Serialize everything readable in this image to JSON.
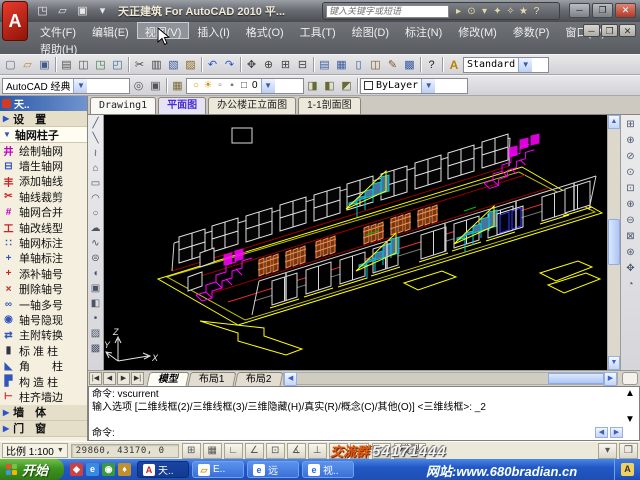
{
  "window": {
    "logo": "A",
    "app_title": "天正建筑 For AutoCAD 2010  平...",
    "controls": {
      "minimize": "─",
      "maximize": "❐",
      "close": "✕"
    },
    "mdi_controls": {
      "minimize": "─",
      "restore": "❐",
      "close": "✕"
    }
  },
  "infocenter": {
    "placeholder": "键入关键字或短语",
    "icons": [
      {
        "n": "infocenter-expand-icon",
        "g": "▸"
      },
      {
        "n": "search-binoculars-icon",
        "g": "⊙"
      },
      {
        "n": "search-dropdown-icon",
        "g": "▾"
      },
      {
        "n": "communication-center-icon",
        "g": "✦"
      },
      {
        "n": "subscription-center-icon",
        "g": "✧"
      },
      {
        "n": "favorites-star-icon",
        "g": "★"
      },
      {
        "n": "help-icon",
        "g": "?"
      }
    ]
  },
  "menu": {
    "items": [
      "文件(F)",
      "编辑(E)",
      "视图(V)",
      "插入(I)",
      "格式(O)",
      "工具(T)",
      "绘图(D)",
      "标注(N)",
      "修改(M)",
      "参数(P)",
      "窗口(W)"
    ],
    "row2": [
      "帮助(H)"
    ],
    "highlighted": "视图(V)"
  },
  "toolbar_standard": {
    "icons": [
      {
        "n": "new-icon",
        "g": "▢",
        "c": "#5a6a80"
      },
      {
        "n": "open-icon",
        "g": "▱",
        "c": "#b08a30"
      },
      {
        "n": "save-icon",
        "g": "▣",
        "c": "#405a8a"
      },
      "|",
      {
        "n": "print-icon",
        "g": "▤",
        "c": "#555"
      },
      {
        "n": "print-preview-icon",
        "g": "◫",
        "c": "#555"
      },
      {
        "n": "publish-icon",
        "g": "◳",
        "c": "#3a7a4a"
      },
      {
        "n": "plot-icon",
        "g": "◰",
        "c": "#3a6a9a"
      },
      "|",
      {
        "n": "cut-icon",
        "g": "✂",
        "c": "#444"
      },
      {
        "n": "copy-icon",
        "g": "▥",
        "c": "#444"
      },
      {
        "n": "paste-icon",
        "g": "▧",
        "c": "#3a5aa0"
      },
      {
        "n": "match-properties-icon",
        "g": "▨",
        "c": "#8a6a20"
      },
      "|",
      {
        "n": "undo-icon",
        "g": "↶",
        "c": "#2a52c8"
      },
      {
        "n": "redo-icon",
        "g": "↷",
        "c": "#2a52c8"
      },
      "|",
      {
        "n": "pan-icon",
        "g": "✥",
        "c": "#444"
      },
      {
        "n": "zoom-realtime-icon",
        "g": "⊕",
        "c": "#444"
      },
      {
        "n": "zoom-window-icon",
        "g": "⊞",
        "c": "#444"
      },
      {
        "n": "zoom-previous-icon",
        "g": "⊟",
        "c": "#444"
      },
      "|",
      {
        "n": "properties-icon",
        "g": "▤",
        "c": "#3a5aa0"
      },
      {
        "n": "designcenter-icon",
        "g": "▦",
        "c": "#3a5aa0"
      },
      {
        "n": "tool-palettes-icon",
        "g": "▯",
        "c": "#3a5aa0"
      },
      {
        "n": "sheetset-manager-icon",
        "g": "◫",
        "c": "#7a5a20"
      },
      {
        "n": "markup-icon",
        "g": "✎",
        "c": "#7a5a20"
      },
      {
        "n": "quickcalc-icon",
        "g": "▩",
        "c": "#3a5aa0"
      },
      "|",
      {
        "n": "help-question-icon",
        "g": "?",
        "c": "#222"
      }
    ],
    "style_icon": "A",
    "text_style": "Standard"
  },
  "toolbar_layers": {
    "workspace": "AutoCAD 经典",
    "workspace_icons": [
      {
        "n": "workspace-settings-gear-icon",
        "g": "◎",
        "c": "#555"
      },
      {
        "n": "workspace-save-icon",
        "g": "▣",
        "c": "#555"
      }
    ],
    "layer_manager_icon": {
      "n": "layer-properties-icon",
      "g": "▦",
      "c": "#7a6a30"
    },
    "layer_combo_icons": [
      {
        "n": "layer-on-bulb-icon",
        "g": "○",
        "c": "#c8a000"
      },
      {
        "n": "layer-freeze-sun-icon",
        "g": "☀",
        "c": "#d09000"
      },
      {
        "n": "layer-lock-icon",
        "g": "▫",
        "c": "#777"
      },
      {
        "n": "layer-plot-icon",
        "g": "▪",
        "c": "#777"
      },
      {
        "n": "layer-color-swatch-icon",
        "g": "□",
        "c": "#333"
      }
    ],
    "current_layer": "0",
    "layer_state_icons": [
      {
        "n": "make-object-layer-icon",
        "g": "◨",
        "c": "#6a6a30"
      },
      {
        "n": "layer-previous-icon",
        "g": "◧",
        "c": "#6a6a30"
      },
      {
        "n": "layer-states-icon",
        "g": "◩",
        "c": "#6a6a30"
      }
    ],
    "color": "ByLayer"
  },
  "doc_tabs": {
    "drawing": "Drawing1",
    "views": [
      "平面图",
      "办公楼正立面图",
      "1-1剖面图"
    ],
    "active_view": "平面图"
  },
  "sidebar": {
    "title": "天..",
    "rows": [
      {
        "t": "group",
        "arrow": "▶",
        "label": "设　置",
        "name": "sidebar-group-settings"
      },
      {
        "t": "group",
        "arrow": "▼",
        "label": "轴网柱子",
        "sel": true,
        "name": "sidebar-group-grid-column"
      },
      {
        "t": "item",
        "g": "井",
        "c": "#c000c0",
        "label": "绘制轴网"
      },
      {
        "t": "item",
        "g": "⊟",
        "c": "#3355bb",
        "label": "墙生轴网"
      },
      {
        "t": "item",
        "g": "丰",
        "c": "#cc2222",
        "label": "添加轴线"
      },
      {
        "t": "item",
        "g": "✂",
        "c": "#cc2222",
        "label": "轴线裁剪"
      },
      {
        "t": "item",
        "g": "#",
        "c": "#c000c0",
        "label": "轴网合并"
      },
      {
        "t": "item",
        "g": "工",
        "c": "#cc2222",
        "label": "轴改线型"
      },
      {
        "t": "item",
        "g": "∷",
        "c": "#3355bb",
        "label": "轴网标注"
      },
      {
        "t": "item",
        "g": "+",
        "c": "#3355bb",
        "label": "单轴标注"
      },
      {
        "t": "item",
        "g": "+",
        "c": "#cc2222",
        "label": "添补轴号"
      },
      {
        "t": "item",
        "g": "×",
        "c": "#cc2222",
        "label": "删除轴号"
      },
      {
        "t": "item",
        "g": "∞",
        "c": "#3355bb",
        "label": "一轴多号"
      },
      {
        "t": "item",
        "g": "◉",
        "c": "#3355bb",
        "label": "轴号隐现"
      },
      {
        "t": "item",
        "g": "⇄",
        "c": "#3355bb",
        "label": "主附转换"
      },
      {
        "t": "item",
        "g": "▮",
        "c": "#333344",
        "label": "标 准 柱"
      },
      {
        "t": "item",
        "g": "◣",
        "c": "#3355bb",
        "label": "角　　柱"
      },
      {
        "t": "item",
        "g": "▛",
        "c": "#3355bb",
        "label": "构 造 柱"
      },
      {
        "t": "item",
        "g": "⊢",
        "c": "#cc2222",
        "label": "柱齐墙边"
      },
      {
        "t": "group",
        "arrow": "▶",
        "label": "墙　体",
        "name": "sidebar-group-wall"
      },
      {
        "t": "group",
        "arrow": "▶",
        "label": "门　窗",
        "name": "sidebar-group-door-window"
      }
    ]
  },
  "draw_toolbar": [
    {
      "n": "line-icon",
      "g": "╱"
    },
    {
      "n": "construction-line-icon",
      "g": "╲"
    },
    {
      "n": "polyline-icon",
      "g": "≀"
    },
    {
      "n": "polygon-icon",
      "g": "⌂"
    },
    {
      "n": "rectangle-icon",
      "g": "▭"
    },
    {
      "n": "arc-icon",
      "g": "◠"
    },
    {
      "n": "circle-icon",
      "g": "○"
    },
    {
      "n": "revcloud-icon",
      "g": "☁"
    },
    {
      "n": "spline-icon",
      "g": "∿"
    },
    {
      "n": "ellipse-icon",
      "g": "⊜"
    },
    {
      "n": "ellipse-arc-icon",
      "g": "◖"
    },
    {
      "n": "insert-block-icon",
      "g": "▣"
    },
    {
      "n": "make-block-icon",
      "g": "◧"
    },
    {
      "n": "point-icon",
      "g": "•"
    },
    {
      "n": "hatch-icon",
      "g": "▨"
    },
    {
      "n": "gradient-icon",
      "g": "▩"
    }
  ],
  "zoom_toolbar": [
    {
      "n": "zoom-window-icon",
      "g": "⊞"
    },
    {
      "n": "zoom-dynamic-icon",
      "g": "⊕"
    },
    {
      "n": "zoom-scale-icon",
      "g": "⊘"
    },
    {
      "n": "zoom-center-icon",
      "g": "⊙"
    },
    {
      "n": "zoom-object-icon",
      "g": "⊡"
    },
    {
      "n": "zoom-in-icon",
      "g": "⊕"
    },
    {
      "n": "zoom-out-icon",
      "g": "⊖"
    },
    {
      "n": "zoom-all-icon",
      "g": "⊠"
    },
    {
      "n": "zoom-extents-icon",
      "g": "⊛"
    },
    {
      "n": "pan-realtime-icon",
      "g": "✥"
    },
    {
      "n": "orbit-icon",
      "g": "◔"
    }
  ],
  "canvas": {
    "ucs": {
      "x": "X",
      "y": "Y",
      "z": "Z"
    },
    "model_description": "两层办公楼三维线框轴测图 (two-storey office building 3D wireframe)"
  },
  "model_tabs": {
    "nav": [
      "|◀",
      "◀",
      "▶",
      "▶|"
    ],
    "tabs": [
      "模型",
      "布局1",
      "布局2"
    ],
    "active": "模型"
  },
  "command_line": {
    "lines": [
      "命令:  vscurrent",
      "输入选项 [二维线框(2)/三维线框(3)/三维隐藏(H)/真实(R)/概念(C)/其他(O)] <三维线框>: _2",
      "命令:"
    ]
  },
  "status_bar": {
    "scale_label": "比例 1:100",
    "coords": "29860, 43170, 0",
    "toggles": [
      {
        "n": "snap-toggle",
        "g": "⊞"
      },
      {
        "n": "grid-toggle",
        "g": "▦"
      },
      {
        "n": "ortho-toggle",
        "g": "∟"
      },
      {
        "n": "polar-toggle",
        "g": "∠"
      },
      {
        "n": "osnap-toggle",
        "g": "⊡"
      },
      {
        "n": "otrack-toggle",
        "g": "∡"
      },
      {
        "n": "ducs-toggle",
        "g": "⊥"
      },
      {
        "n": "dyn-toggle",
        "g": "↗"
      },
      {
        "n": "lwt-toggle",
        "g": "≡"
      }
    ],
    "paper_button": "□",
    "model_button": "模型",
    "right_icons": [
      {
        "n": "toolbar-unlock-icon",
        "g": "▾"
      },
      {
        "n": "clean-screen-icon",
        "g": "❒"
      }
    ]
  },
  "watermarks": {
    "qq_label": "交流群",
    "qq_number": "54171444",
    "website": "网站:www.680bradian.cn"
  },
  "taskbar": {
    "start": "开始",
    "quick_launch": [
      {
        "n": "quicklaunch-media-icon",
        "g": "◆",
        "c": "#d04040"
      },
      {
        "n": "quicklaunch-ie-icon",
        "g": "e",
        "c": "#3a8ae0"
      },
      {
        "n": "quicklaunch-desktop-icon",
        "g": "◉",
        "c": "#3a9a40"
      },
      {
        "n": "quicklaunch-player-icon",
        "g": "♦",
        "c": "#c09030"
      }
    ],
    "tasks": [
      {
        "label": "天..",
        "icon": "A",
        "ic": "#cc2222",
        "active": true,
        "n": "task-tarch"
      },
      {
        "label": "E..",
        "icon": "▱",
        "ic": "#c8a020",
        "active": false,
        "n": "task-explorer"
      },
      {
        "label": "远",
        "icon": "e",
        "ic": "#2a6ad0",
        "active": false,
        "n": "task-ie-1"
      },
      {
        "label": "视..",
        "icon": "e",
        "ic": "#2a6ad0",
        "active": false,
        "n": "task-ie-2"
      }
    ],
    "tray_icons": [
      {
        "n": "tray-input-language-icon",
        "g": "A"
      }
    ]
  }
}
